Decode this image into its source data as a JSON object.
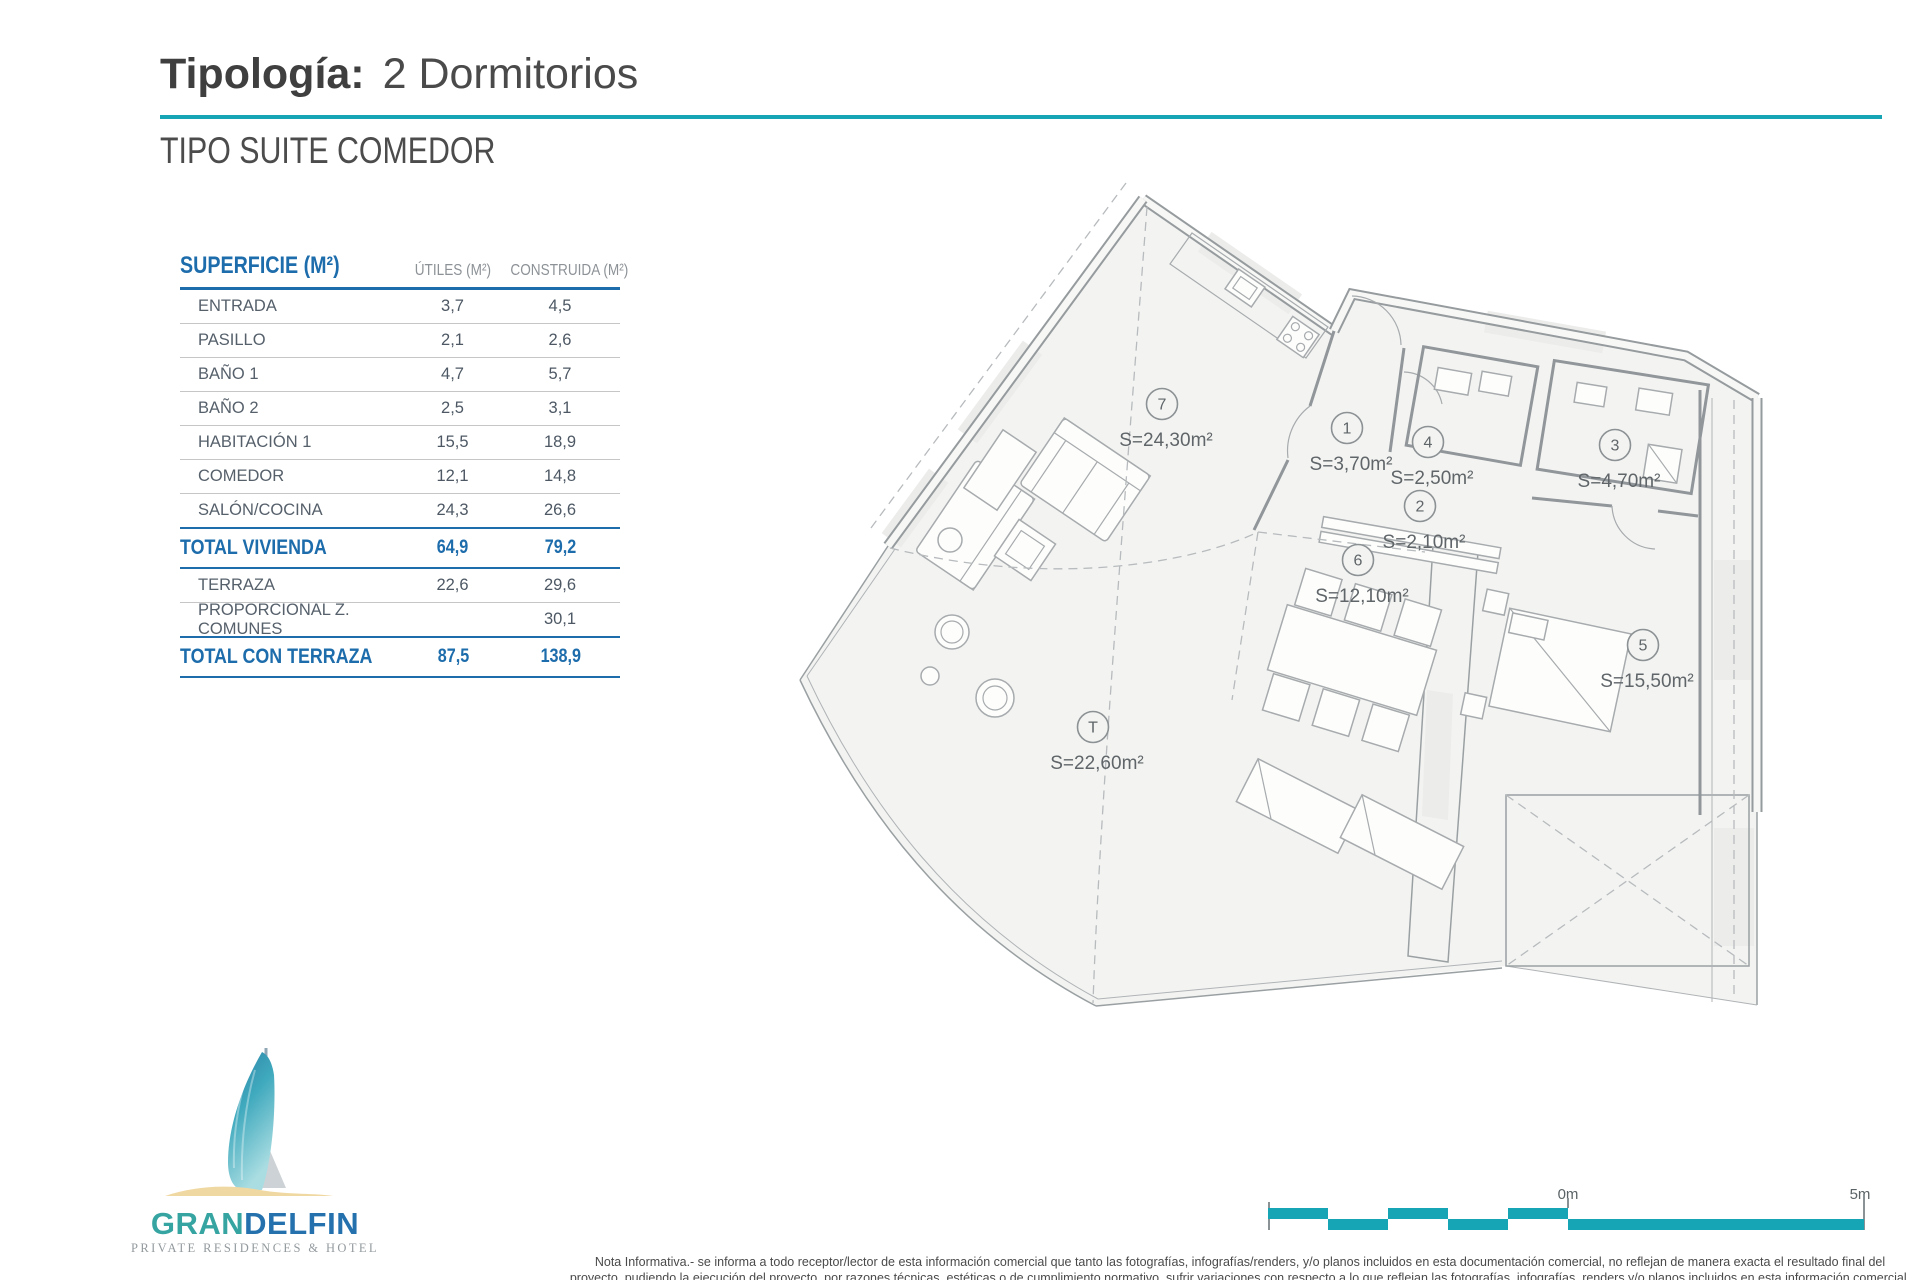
{
  "header": {
    "title_label": "Tipología:",
    "title_value": "2 Dormitorios",
    "subtitle": "TIPO SUITE COMEDOR"
  },
  "table": {
    "col_room": "SUPERFICIE (M²)",
    "col_utiles": "ÚTILES (M²)",
    "col_construida": "CONSTRUIDA (M²)",
    "rows": [
      {
        "label": "ENTRADA",
        "utiles": "3,7",
        "construida": "4,5",
        "total": false
      },
      {
        "label": "PASILLO",
        "utiles": "2,1",
        "construida": "2,6",
        "total": false
      },
      {
        "label": "BAÑO 1",
        "utiles": "4,7",
        "construida": "5,7",
        "total": false
      },
      {
        "label": "BAÑO 2",
        "utiles": "2,5",
        "construida": "3,1",
        "total": false
      },
      {
        "label": "HABITACIÓN 1",
        "utiles": "15,5",
        "construida": "18,9",
        "total": false
      },
      {
        "label": "COMEDOR",
        "utiles": "12,1",
        "construida": "14,8",
        "total": false
      },
      {
        "label": "SALÓN/COCINA",
        "utiles": "24,3",
        "construida": "26,6",
        "total": false
      },
      {
        "label": "TOTAL VIVIENDA",
        "utiles": "64,9",
        "construida": "79,2",
        "total": true
      },
      {
        "label": "TERRAZA",
        "utiles": "22,6",
        "construida": "29,6",
        "total": false
      },
      {
        "label": "PROPORCIONAL Z. COMUNES",
        "utiles": "",
        "construida": "30,1",
        "total": false
      },
      {
        "label": "TOTAL CON TERRAZA",
        "utiles": "87,5",
        "construida": "138,9",
        "total": true
      }
    ]
  },
  "floorplan": {
    "room_labels": [
      {
        "id": "7",
        "area": "S=24,30m²"
      },
      {
        "id": "1",
        "area": "S=3,70m²"
      },
      {
        "id": "4",
        "area": "S=2,50m²"
      },
      {
        "id": "3",
        "area": "S=4,70m²"
      },
      {
        "id": "2",
        "area": "S=2,10m²"
      },
      {
        "id": "6",
        "area": "S=12,10m²"
      },
      {
        "id": "5",
        "area": "S=15,50m²"
      },
      {
        "id": "T",
        "area": "S=22,60m²"
      }
    ]
  },
  "scale_bar": {
    "start_label": "0m",
    "end_label": "5m"
  },
  "logo": {
    "brand_primary": "GRAN",
    "brand_secondary": "DELFIN",
    "tagline": "PRIVATE RESIDENCES & HOTEL"
  },
  "footnote": {
    "line1": "Nota Informativa.- se informa a todo receptor/lector de esta información comercial que tanto las fotografías, infografías/renders, y/o planos incluidos en esta documentación comercial, no reflejan de manera exacta el resultado final del",
    "line2": "proyecto, pudiendo la ejecución del proyecto, por razones técnicas, estéticas o de cumplimiento normativo, sufrir variaciones con respecto a lo que reflejan las fotografías, infografías, renders y/o planos incluidos en esta información comercial."
  },
  "colors": {
    "accent_teal": "#16a5b5",
    "accent_blue": "#1d6cab",
    "logo_teal": "#36a5a2",
    "logo_blue": "#2471ae",
    "sand": "#f0d8a2"
  }
}
